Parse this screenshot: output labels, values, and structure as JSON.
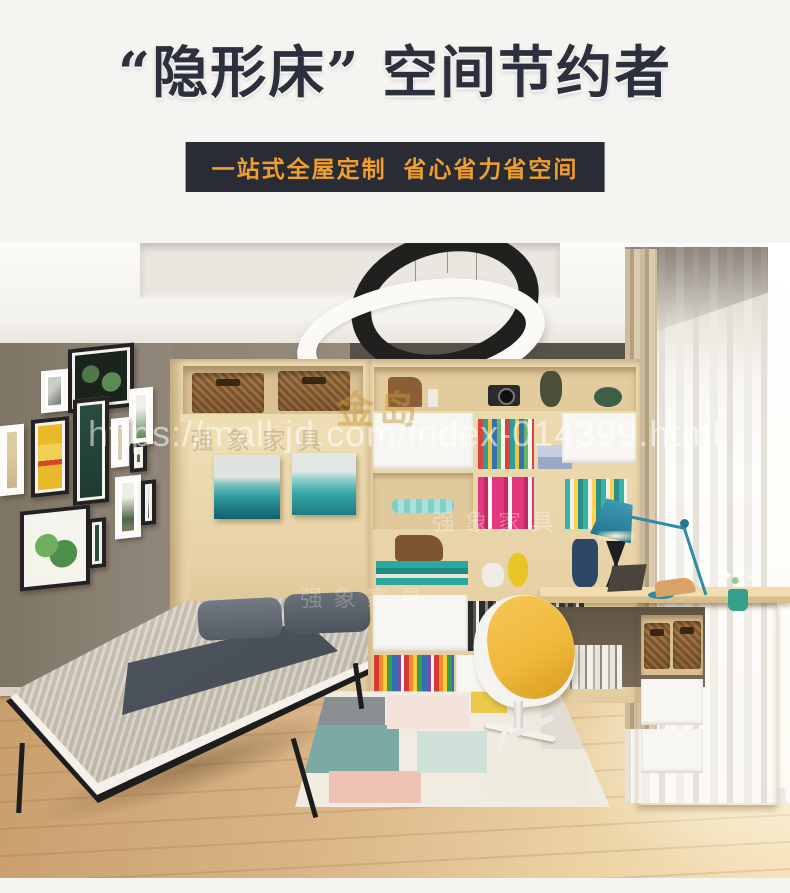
{
  "header": {
    "title": "“隐形床” 空间节约者",
    "banner": "一站式全屋定制  省心省力省空间"
  },
  "photo": {
    "watermark_url": "https://mall.jd.com/index-014399.html",
    "watermark_gold": "金岛",
    "watermark_brand": "强象家具"
  },
  "colors": {
    "title_text": "#2c2f3c",
    "banner_bg": "#2a2c35",
    "banner_text": "#f09e2d",
    "wall_taupe": "#8d8478",
    "wood_light": "#e7d3a8",
    "lamp_teal": "#2f8ca6",
    "chair_yellow": "#f0b93c"
  }
}
